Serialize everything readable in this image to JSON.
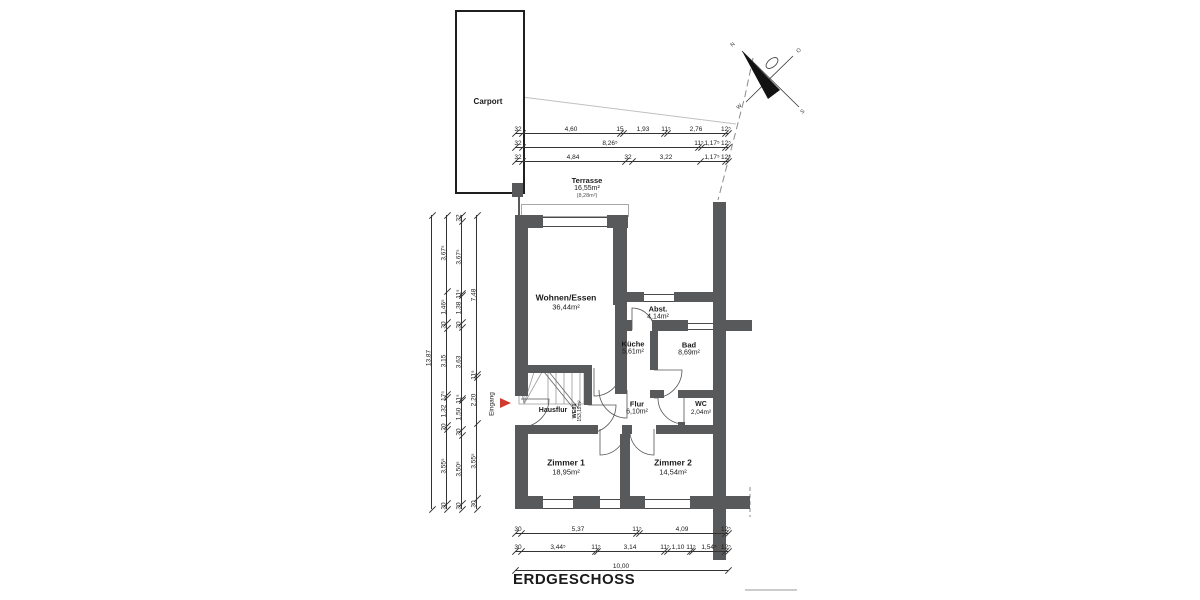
{
  "title": "ERDGESCHOSS",
  "carport": {
    "label": "Carport"
  },
  "entrance": {
    "label": "Eingang"
  },
  "unit": {
    "code": "WE01",
    "area": "153,12m²"
  },
  "compass": {
    "n": "N",
    "o": "O",
    "s": "S",
    "w": "W"
  },
  "rooms": {
    "terrasse": {
      "name": "Terrasse",
      "area": "16,55m²",
      "note": "(8,28m²)"
    },
    "wohnen": {
      "name": "Wohnen/Essen",
      "area": "36,44m²"
    },
    "abst": {
      "name": "Abst.",
      "area": "4,14m²"
    },
    "kueche": {
      "name": "Küche",
      "area": "5,61m²"
    },
    "bad": {
      "name": "Bad",
      "area": "8,69m²"
    },
    "flur": {
      "name": "Flur",
      "area": "6,10m²"
    },
    "wc": {
      "name": "WC",
      "area": "2,04m²"
    },
    "hausflur": {
      "name": "Hausflur"
    },
    "zimmer1": {
      "name": "Zimmer 1",
      "area": "18,95m²"
    },
    "zimmer2": {
      "name": "Zimmer 2",
      "area": "14,54m²"
    }
  },
  "dimensions": {
    "top": [
      {
        "y": 133,
        "x1": 515,
        "x2": 728,
        "ticks": [
          515,
          522,
          620,
          623,
          664,
          667,
          725,
          728
        ],
        "labels": [
          {
            "t": "32",
            "x": 518
          },
          {
            "t": "4,60",
            "x": 571
          },
          {
            "t": "15",
            "x": 620
          },
          {
            "t": "1,93",
            "x": 643
          },
          {
            "t": "11⁵",
            "x": 666
          },
          {
            "t": "2,76",
            "x": 696
          },
          {
            "t": "12⁵",
            "x": 726
          }
        ]
      },
      {
        "y": 147,
        "x1": 515,
        "x2": 728,
        "ticks": [
          515,
          522,
          698,
          701,
          725,
          728
        ],
        "labels": [
          {
            "t": "32",
            "x": 518
          },
          {
            "t": "8,26⁵",
            "x": 610
          },
          {
            "t": "11⁵",
            "x": 699
          },
          {
            "t": "1,17⁵",
            "x": 712
          },
          {
            "t": "12⁵",
            "x": 726
          }
        ]
      },
      {
        "y": 161,
        "x1": 515,
        "x2": 728,
        "ticks": [
          515,
          522,
          625,
          632,
          700,
          725,
          728
        ],
        "labels": [
          {
            "t": "32",
            "x": 518
          },
          {
            "t": "4,84",
            "x": 573
          },
          {
            "t": "32",
            "x": 628
          },
          {
            "t": "3,22",
            "x": 666
          },
          {
            "t": "1,17⁵",
            "x": 712
          },
          {
            "t": "12⁵",
            "x": 726
          }
        ]
      }
    ],
    "bottom": [
      {
        "y": 533,
        "x1": 515,
        "x2": 728,
        "ticks": [
          515,
          521,
          636,
          639,
          725,
          728
        ],
        "labels": [
          {
            "t": "30",
            "x": 518
          },
          {
            "t": "5,37",
            "x": 578
          },
          {
            "t": "11⁵",
            "x": 637
          },
          {
            "t": "4,09",
            "x": 682
          },
          {
            "t": "12⁵",
            "x": 726
          }
        ]
      },
      {
        "y": 551,
        "x1": 515,
        "x2": 728,
        "ticks": [
          515,
          521,
          595,
          597,
          664,
          667,
          690,
          692,
          725,
          728
        ],
        "labels": [
          {
            "t": "30",
            "x": 518
          },
          {
            "t": "3,44⁵",
            "x": 558
          },
          {
            "t": "11⁵",
            "x": 596
          },
          {
            "t": "3,14",
            "x": 630
          },
          {
            "t": "11⁵",
            "x": 665
          },
          {
            "t": "1,10",
            "x": 678
          },
          {
            "t": "11⁵",
            "x": 691
          },
          {
            "t": "1,54⁵",
            "x": 709
          },
          {
            "t": "12⁵",
            "x": 726
          }
        ]
      },
      {
        "y": 570,
        "x1": 515,
        "x2": 728,
        "ticks": [
          515,
          728
        ],
        "labels": [
          {
            "t": "10,00",
            "x": 621
          }
        ]
      }
    ],
    "left": [
      {
        "x": 431,
        "y1": 215,
        "y2": 509,
        "ticks": [
          215,
          509
        ],
        "labels": [
          {
            "t": "13,87",
            "y": 358
          }
        ]
      },
      {
        "x": 446,
        "y1": 215,
        "y2": 509,
        "ticks": [
          215,
          291,
          322,
          328,
          394,
          397,
          425,
          429,
          503,
          509
        ],
        "labels": [
          {
            "t": "3,67⁵",
            "y": 253
          },
          {
            "t": "1,46⁵",
            "y": 307
          },
          {
            "t": "30",
            "y": 325
          },
          {
            "t": "3,15",
            "y": 361
          },
          {
            "t": "17⁵",
            "y": 396
          },
          {
            "t": "1,32",
            "y": 411
          },
          {
            "t": "20",
            "y": 427
          },
          {
            "t": "3,55⁵",
            "y": 466
          },
          {
            "t": "30",
            "y": 506
          }
        ]
      },
      {
        "x": 461,
        "y1": 215,
        "y2": 509,
        "ticks": [
          215,
          221,
          293,
          295,
          322,
          327,
          398,
          400,
          429,
          435,
          503,
          509
        ],
        "labels": [
          {
            "t": "32",
            "y": 218
          },
          {
            "t": "3,67⁵",
            "y": 257
          },
          {
            "t": "11⁵",
            "y": 294
          },
          {
            "t": "1,38",
            "y": 308
          },
          {
            "t": "30",
            "y": 325
          },
          {
            "t": "3,63",
            "y": 362
          },
          {
            "t": "11⁵",
            "y": 399
          },
          {
            "t": "1,50",
            "y": 414
          },
          {
            "t": "30",
            "y": 432
          },
          {
            "t": "3,50⁵",
            "y": 469
          },
          {
            "t": "30",
            "y": 506
          }
        ]
      },
      {
        "x": 476,
        "y1": 215,
        "y2": 509,
        "ticks": [
          215,
          374,
          377,
          423,
          498,
          509
        ],
        "labels": [
          {
            "t": "7,48",
            "y": 295
          },
          {
            "t": "11⁵",
            "y": 375
          },
          {
            "t": "2,20",
            "y": 400
          },
          {
            "t": "3,55⁵",
            "y": 461
          },
          {
            "t": "30",
            "y": 504
          }
        ]
      }
    ]
  }
}
